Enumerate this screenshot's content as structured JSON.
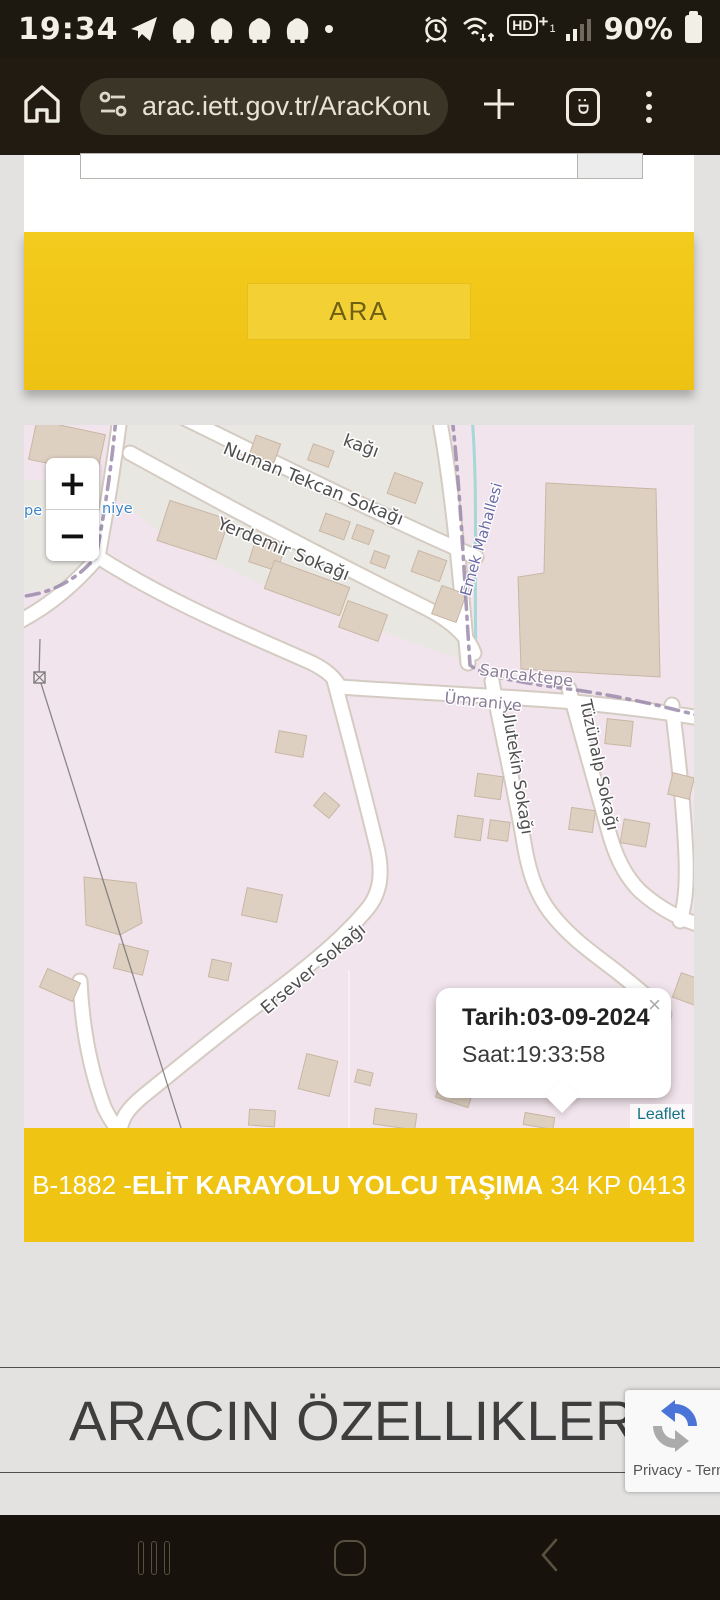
{
  "status_bar": {
    "time": "19:34",
    "battery_percent": "90%",
    "network_label": "HD",
    "network_plus": "+",
    "network_sub": "1"
  },
  "browser": {
    "url": "arac.iett.gov.tr/AracKonumu",
    "tab_count_badge": ":D",
    "plus_label": "+"
  },
  "search_form": {
    "ara_button_label": "ARA"
  },
  "map": {
    "zoom_in": "+",
    "zoom_out": "−",
    "attribution": "Leaflet",
    "popup": {
      "line1": "Tarih:03-09-2024",
      "line2": "Saat:19:33:58",
      "close": "×"
    },
    "labels": {
      "street_partial": "kağı",
      "numan": "Numan Tekcan Sokağı",
      "yerdemir": "Yerdemir Sokağı",
      "emek": "Emek Mahallesi",
      "sancaktepe": "Sancaktepe",
      "umraniye": "Ümraniye",
      "tuzunalp": "Tüzünalp Sokağı",
      "ulutekin": "Ulutekin Sokağı",
      "ersever": "Ersever Sokağı",
      "place_left_partial": "pe",
      "place_right_partial": "niye"
    },
    "colors": {
      "pink": "#f2e4ec",
      "gray_zone": "#e9e7e2",
      "building": "#ded0c1",
      "building_stroke": "#c8b6a4",
      "road_casing": "#d4cbc2",
      "boundary": "#9c8bab",
      "stream": "#a5d8d6",
      "street_label": "#4e4e4e",
      "place_label": "#8a7d98",
      "district_label": "#6a69a5",
      "blue_place_label": "#3d85c6",
      "attribution_color": "#127387"
    }
  },
  "vehicle_bar": {
    "prefix": "B-1882 -",
    "operator": "ELİT KARAYOLU YOLCU TAŞIMA",
    "plate": " 34 KP 0413",
    "bar_color": "#f0c413"
  },
  "section": {
    "heading": "ARACIN ÖZELLIKLERI"
  },
  "recaptcha": {
    "terms_text": "Privacy - Terms"
  }
}
